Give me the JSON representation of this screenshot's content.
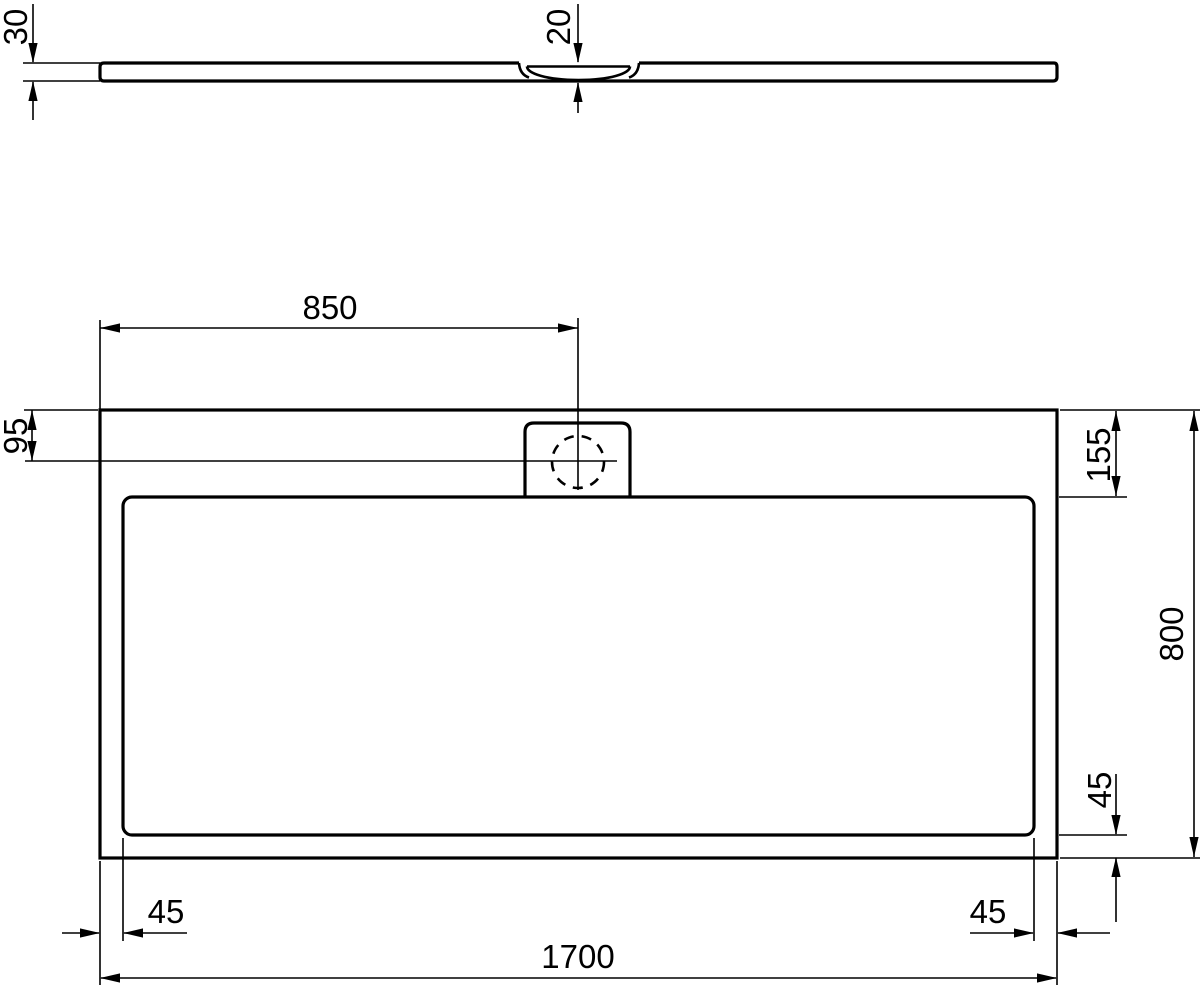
{
  "drawing": {
    "background_color": "#ffffff",
    "line_color": "#000000",
    "dims": {
      "side_thickness": "30",
      "side_drain_depth": "20",
      "drain_from_left": "850",
      "drain_from_top": "95",
      "border_top_right": "155",
      "overall_width": "800",
      "border_right_side": "45",
      "border_bottom_left": "45",
      "border_bottom_right": "45",
      "overall_length": "1700"
    }
  }
}
